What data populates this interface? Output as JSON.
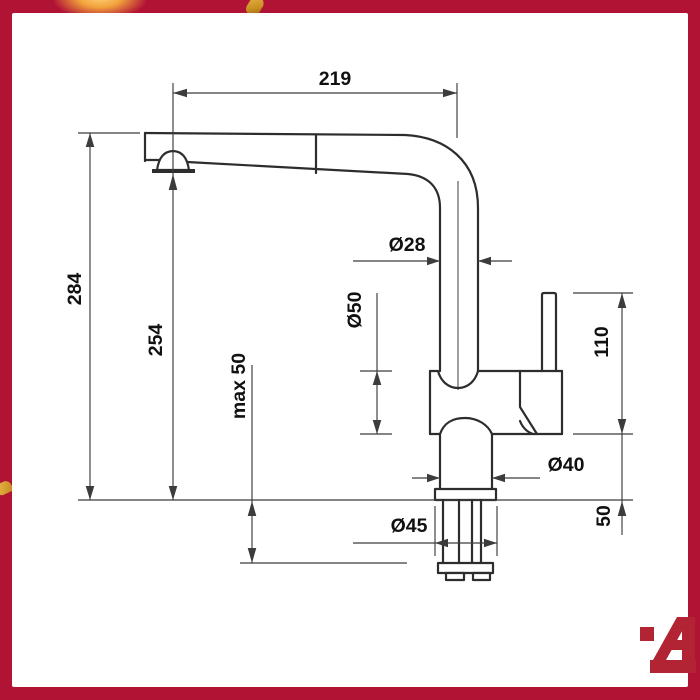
{
  "colors": {
    "frame": "#b11335",
    "line": "#2d2d2d",
    "dim": "#3c3c3c",
    "text": "#111111",
    "gold": "#e7b54a",
    "logo": "#b22433"
  },
  "drawing": {
    "dimensions": {
      "spout_reach": "219",
      "total_height": "284",
      "spout_outlet_height": "254",
      "max_counter_thickness": "max 50",
      "pipe_diameter": "Ø28",
      "body_diameter": "Ø50",
      "handle_body_height": "110",
      "neck_diameter": "Ø40",
      "base_diameter": "Ø45",
      "shank_depth": "50"
    }
  },
  "branding": {
    "logo_letter": "A"
  }
}
